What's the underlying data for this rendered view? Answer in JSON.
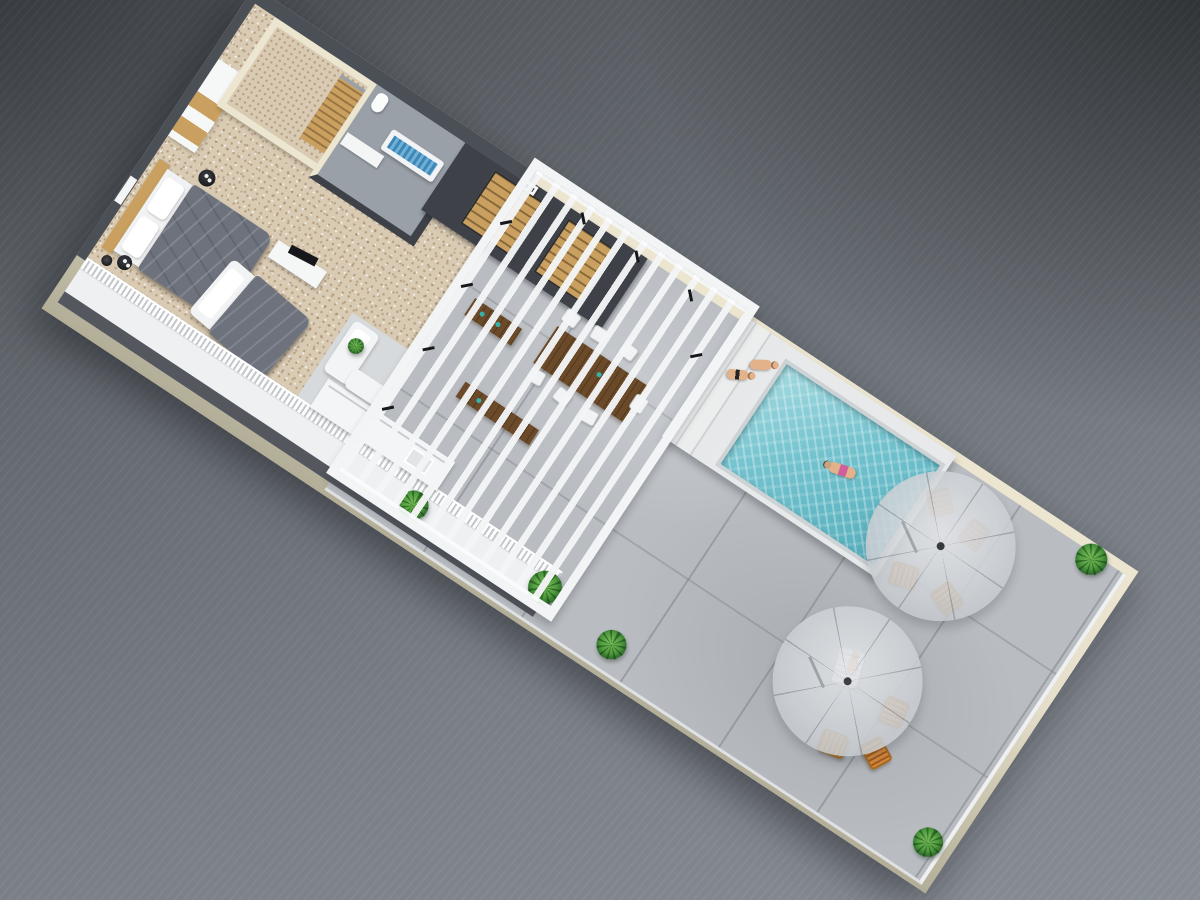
{
  "scene": {
    "type": "isometric-3d-floorplan-render",
    "subject": "rooftop-penthouse-level-with-pool-terrace",
    "rooms": [
      "bedroom",
      "walk-in-closet",
      "bathroom",
      "stair-core",
      "pergola-lounge",
      "kitchenette",
      "balcony-walkway",
      "pool-deck",
      "terrace"
    ],
    "counts": {
      "umbrellas": 2,
      "deck_chairs": 7,
      "dining_chairs": 7,
      "people": 4,
      "plants": 6,
      "beds": 2
    },
    "palette": {
      "bg_dark": "#4e5257",
      "bg_light": "#8a8f97",
      "cream": "#ece6d1",
      "olive": "#b3ae98",
      "carpet": "#d8cab3",
      "wall_dark": "#4b4f56",
      "wall_darker": "#3e4248",
      "struct_white": "#f3f4f5",
      "tile": "#b9bdc2",
      "platform": "#e7e9ea",
      "pool": "#72c2ce",
      "pool_deep": "#56aebc",
      "orange": "#d8893a",
      "orange_dark": "#a96a22",
      "wood": "#6b4a2a",
      "wood_light": "#c9a05f",
      "green": "#4f9a3e",
      "skin": "#e4b28a",
      "blanket": "#6d727d"
    },
    "building": {
      "center_x": 590,
      "center_y": 440,
      "length": 1060,
      "depth": 386,
      "rotation_deg": 33.5
    },
    "props": [
      {
        "t": "plant",
        "x": 419,
        "y": 345,
        "s": 30
      },
      {
        "t": "plant",
        "x": 574,
        "y": 341,
        "s": 34
      },
      {
        "t": "plant",
        "x": 661,
        "y": 352,
        "s": 30
      },
      {
        "t": "plant",
        "x": 1014,
        "y": 16,
        "s": 32
      },
      {
        "t": "plant",
        "x": 1034,
        "y": 342,
        "s": 30
      },
      {
        "t": "plant",
        "x": 283,
        "y": 244,
        "s": 16
      },
      {
        "t": "wood",
        "x": 494,
        "y": 138,
        "w": 108,
        "h": 44
      },
      {
        "t": "wood",
        "x": 384,
        "y": 148,
        "w": 56,
        "h": 20
      },
      {
        "t": "wood",
        "x": 438,
        "y": 222,
        "w": 88,
        "h": 18
      },
      {
        "t": "dchair",
        "x": 447,
        "y": 102,
        "rot": 4
      },
      {
        "t": "dchair",
        "x": 480,
        "y": 100,
        "rot": -3
      },
      {
        "t": "dchair",
        "x": 513,
        "y": 98,
        "rot": 5
      },
      {
        "t": "dchair",
        "x": 450,
        "y": 170,
        "rot": -4
      },
      {
        "t": "dchair",
        "x": 483,
        "y": 172,
        "rot": 6
      },
      {
        "t": "dchair",
        "x": 516,
        "y": 174,
        "rot": -5
      },
      {
        "t": "dchair",
        "x": 551,
        "y": 136,
        "rot": 90
      },
      {
        "t": "umbrella",
        "x": 881,
        "y": 88
      },
      {
        "t": "umbrella",
        "x": 878,
        "y": 252
      },
      {
        "t": "chair",
        "x": 915,
        "y": 128,
        "rot": 20
      },
      {
        "t": "chair",
        "x": 866,
        "y": 133,
        "rot": -18
      },
      {
        "t": "chair",
        "x": 903,
        "y": 60,
        "rot": 95,
        "f": true
      },
      {
        "t": "chair",
        "x": 856,
        "y": 52,
        "rot": 45,
        "f": true
      },
      {
        "t": "chair",
        "x": 900,
        "y": 312,
        "rot": -12
      },
      {
        "t": "chair",
        "x": 941,
        "y": 296,
        "rot": 28
      },
      {
        "t": "chair",
        "x": 934,
        "y": 252,
        "rot": 80
      },
      {
        "t": "lounger",
        "x": 871,
        "y": 240,
        "rot": -18,
        "w": 26,
        "h": 38
      },
      {
        "t": "person",
        "x": 617,
        "y": 57,
        "rot": 62,
        "v": "suit"
      },
      {
        "t": "person",
        "x": 631,
        "y": 36,
        "rot": 58
      },
      {
        "t": "person",
        "x": 757,
        "y": 79,
        "rot": -15,
        "v": "swim"
      },
      {
        "t": "person",
        "x": 873,
        "y": 236,
        "rot": -18,
        "v": "sit"
      },
      {
        "t": "brace",
        "x": 340,
        "y": 58,
        "rot": 45
      },
      {
        "t": "brace",
        "x": 342,
        "y": 132,
        "rot": 45
      },
      {
        "t": "brace",
        "x": 345,
        "y": 206,
        "rot": 45
      },
      {
        "t": "brace",
        "x": 344,
        "y": 278,
        "rot": 45
      },
      {
        "t": "brace",
        "x": 402,
        "y": 12,
        "rot": -45
      },
      {
        "t": "brace",
        "x": 468,
        "y": 14,
        "rot": -45
      },
      {
        "t": "brace",
        "x": 534,
        "y": 17,
        "rot": -45
      },
      {
        "t": "brace",
        "x": 572,
        "y": 64,
        "rot": 45
      },
      {
        "t": "sidetable",
        "x": 66,
        "y": 186,
        "s": 17
      },
      {
        "t": "sidetable",
        "x": 44,
        "y": 302,
        "s": 15
      },
      {
        "t": "lamp",
        "x": 28,
        "y": 310,
        "s": 11
      },
      {
        "t": "plaque",
        "x": 340,
        "y": 16,
        "w": 16,
        "h": 10
      }
    ]
  }
}
